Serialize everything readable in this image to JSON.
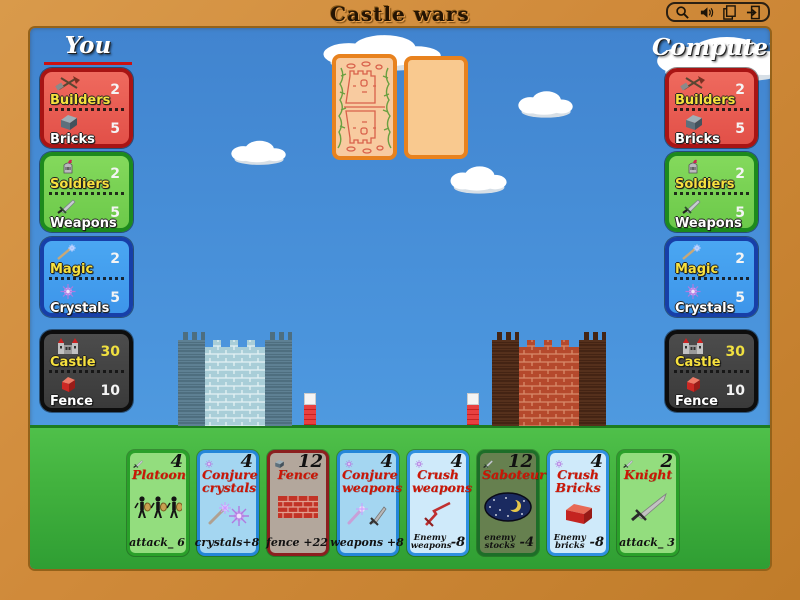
{
  "window": {
    "title": "Castle wars",
    "toolbar_icons": [
      "magnifier-icon",
      "sound-icon",
      "pages-icon",
      "exit-icon"
    ]
  },
  "colors": {
    "frame": "#d08a3a",
    "sky": "#4b95dd",
    "grass": "#3fae3c",
    "turn_indicator": "#cc1111",
    "builders_panel": "#e25048",
    "soldiers_panel": "#6cc94a",
    "magic_panel": "#3d95ea",
    "castle_panel": "#3a3a3a",
    "card_border_orange": "#e8821e",
    "card_title_red": "#cc1505"
  },
  "players": {
    "you": {
      "name": "You",
      "active_turn": true,
      "panels": [
        {
          "rows": [
            {
              "icon": "hammers-icon",
              "label": "Builders",
              "value": "2"
            },
            {
              "icon": "brick-icon",
              "label": "Bricks",
              "value": "5"
            }
          ]
        },
        {
          "rows": [
            {
              "icon": "knight-helmet-icon",
              "label": "Soldiers",
              "value": "2"
            },
            {
              "icon": "sword-icon",
              "label": "Weapons",
              "value": "5"
            }
          ]
        },
        {
          "rows": [
            {
              "icon": "wand-icon",
              "label": "Magic",
              "value": "2"
            },
            {
              "icon": "crystal-icon",
              "label": "Crystals",
              "value": "5"
            }
          ]
        },
        {
          "rows": [
            {
              "icon": "castle-icon",
              "label": "Castle",
              "value": "30"
            },
            {
              "icon": "redbrick-icon",
              "label": "Fence",
              "value": "10"
            }
          ]
        }
      ]
    },
    "computer": {
      "name": "Computer",
      "active_turn": false,
      "panels": [
        {
          "rows": [
            {
              "icon": "hammers-icon",
              "label": "Builders",
              "value": "2"
            },
            {
              "icon": "brick-icon",
              "label": "Bricks",
              "value": "5"
            }
          ]
        },
        {
          "rows": [
            {
              "icon": "knight-helmet-icon",
              "label": "Soldiers",
              "value": "2"
            },
            {
              "icon": "sword-icon",
              "label": "Weapons",
              "value": "5"
            }
          ]
        },
        {
          "rows": [
            {
              "icon": "wand-icon",
              "label": "Magic",
              "value": "2"
            },
            {
              "icon": "crystal-icon",
              "label": "Crystals",
              "value": "5"
            }
          ]
        },
        {
          "rows": [
            {
              "icon": "castle-icon",
              "label": "Castle",
              "value": "30"
            },
            {
              "icon": "redbrick-icon",
              "label": "Fence",
              "value": "10"
            }
          ]
        }
      ]
    }
  },
  "hand": [
    {
      "title": "Platoon",
      "cost": "4",
      "cost_icon": "sword-icon",
      "art": "soldiers-art",
      "effect_text": "attack_ 6",
      "effect_value": "",
      "theme_color": "#93dd7e"
    },
    {
      "title": "Conjure crystals",
      "cost": "4",
      "cost_icon": "crystal-icon",
      "art": "wand-crystal-art",
      "effect_text": "crystals+8",
      "effect_value": "",
      "theme_color": "#a4d6f1"
    },
    {
      "title": "Fence",
      "cost": "12",
      "cost_icon": "brick-icon",
      "art": "brick-wall-art",
      "effect_text": "fence +22",
      "effect_value": "",
      "theme_color": "#b3a79c"
    },
    {
      "title": "Conjure weapons",
      "cost": "4",
      "cost_icon": "crystal-icon",
      "art": "wand-sword-art",
      "effect_text": "weapons +8",
      "effect_value": "",
      "theme_color": "#a4d6f1"
    },
    {
      "title": "Crush weapons",
      "cost": "4",
      "cost_icon": "crystal-icon",
      "art": "broken-sword-art",
      "effect_text": "Enemy weapons",
      "effect_value": "-8",
      "theme_color": "#cfeafa"
    },
    {
      "title": "Saboteur",
      "cost": "12",
      "cost_icon": "sword-icon",
      "art": "night-moon-art",
      "effect_text": "enemy stocks",
      "effect_value": "-4",
      "theme_color": "#66804f"
    },
    {
      "title": "Crush Bricks",
      "cost": "4",
      "cost_icon": "crystal-icon",
      "art": "red-brick-art",
      "effect_text": "Enemy bricks",
      "effect_value": "-8",
      "theme_color": "#cfeafa"
    },
    {
      "title": "Knight",
      "cost": "2",
      "cost_icon": "sword-icon",
      "art": "sword-art",
      "effect_text": "attack_ 3",
      "effect_value": "",
      "theme_color": "#93dd7e"
    }
  ]
}
